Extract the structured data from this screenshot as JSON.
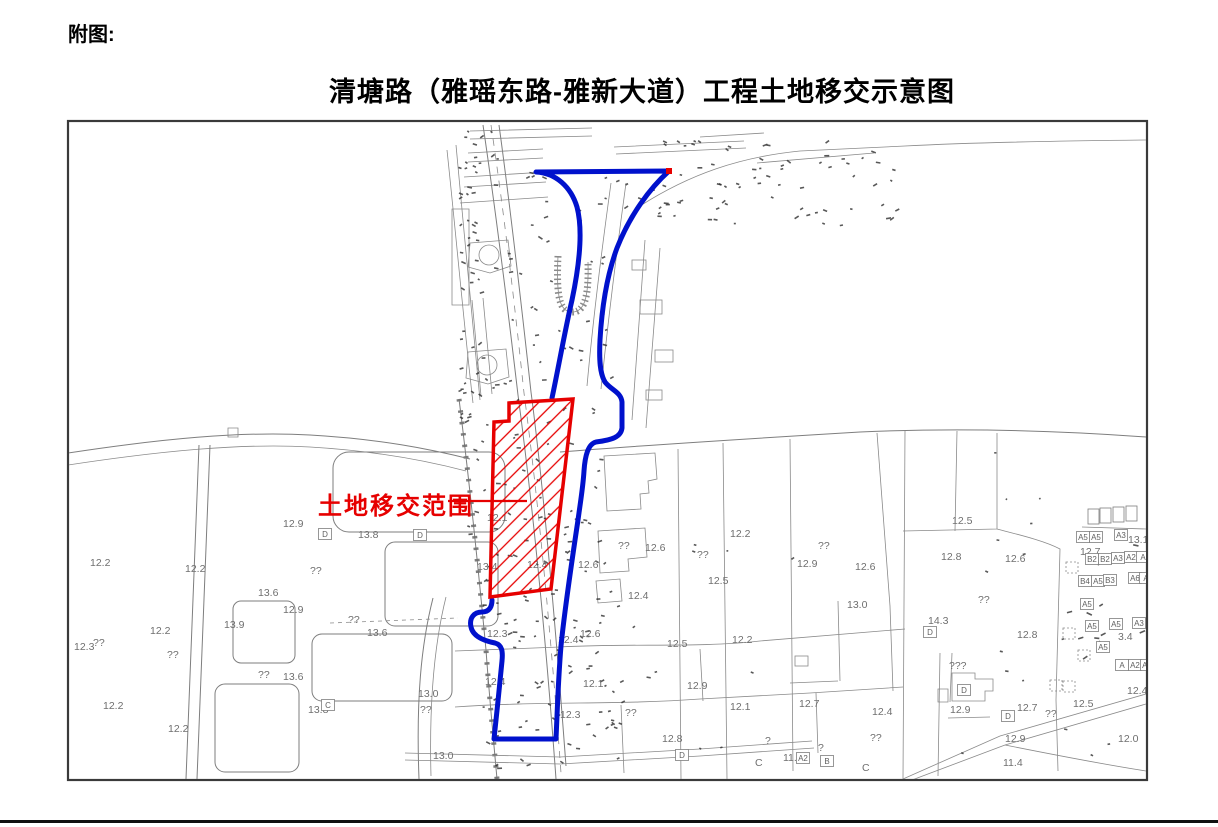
{
  "page": {
    "figure_label": "附图:",
    "title": "清塘路（雅瑶东路-雅新大道）工程土地移交示意图"
  },
  "map": {
    "legend_label": "土地移交范围",
    "colors": {
      "boundary_blue": "#0011cc",
      "transfer_red": "#e60000",
      "base_gray": "#7e7e7e",
      "label_gray": "#6f6f6f"
    },
    "elevation_labels": [
      {
        "t": "12.9",
        "x": 283,
        "y": 527
      },
      {
        "t": "13.8",
        "x": 358,
        "y": 538
      },
      {
        "t": "12.2",
        "x": 90,
        "y": 566
      },
      {
        "t": "12.2",
        "x": 185,
        "y": 572
      },
      {
        "t": "13.6",
        "x": 258,
        "y": 596
      },
      {
        "t": "12.9",
        "x": 283,
        "y": 613
      },
      {
        "t": "??",
        "x": 310,
        "y": 574
      },
      {
        "t": "13.9",
        "x": 224,
        "y": 628
      },
      {
        "t": "??",
        "x": 93,
        "y": 646
      },
      {
        "t": "12.2",
        "x": 150,
        "y": 634
      },
      {
        "t": "12.3",
        "x": 74,
        "y": 650
      },
      {
        "t": "??",
        "x": 167,
        "y": 658
      },
      {
        "t": "12.2",
        "x": 103,
        "y": 709
      },
      {
        "t": "12.2",
        "x": 168,
        "y": 732
      },
      {
        "t": "??",
        "x": 348,
        "y": 623
      },
      {
        "t": "13.6",
        "x": 367,
        "y": 636
      },
      {
        "t": "??",
        "x": 258,
        "y": 678
      },
      {
        "t": "13.6",
        "x": 283,
        "y": 680
      },
      {
        "t": "13.0",
        "x": 418,
        "y": 697
      },
      {
        "t": "13.8",
        "x": 308,
        "y": 713
      },
      {
        "t": "??",
        "x": 420,
        "y": 713
      },
      {
        "t": "13.0",
        "x": 433,
        "y": 759
      },
      {
        "t": "12.1",
        "x": 487,
        "y": 521
      },
      {
        "t": "13.4",
        "x": 477,
        "y": 570
      },
      {
        "t": "12.4",
        "x": 527,
        "y": 568
      },
      {
        "t": "12.3",
        "x": 487,
        "y": 637
      },
      {
        "t": "12.4",
        "x": 485,
        "y": 685
      },
      {
        "t": "12.6",
        "x": 578,
        "y": 568
      },
      {
        "t": "12.4",
        "x": 628,
        "y": 599
      },
      {
        "t": "12.6",
        "x": 580,
        "y": 637
      },
      {
        "t": "12.4",
        "x": 558,
        "y": 643
      },
      {
        "t": "12.1",
        "x": 583,
        "y": 687
      },
      {
        "t": "12.3",
        "x": 560,
        "y": 718
      },
      {
        "t": "??",
        "x": 625,
        "y": 716
      },
      {
        "t": "12.8",
        "x": 662,
        "y": 742
      },
      {
        "t": "12.9",
        "x": 687,
        "y": 689
      },
      {
        "t": "12.5",
        "x": 667,
        "y": 647
      },
      {
        "t": "12.2",
        "x": 732,
        "y": 643
      },
      {
        "t": "12.2",
        "x": 730,
        "y": 537
      },
      {
        "t": "12.5",
        "x": 708,
        "y": 584
      },
      {
        "t": "12.1",
        "x": 730,
        "y": 710
      },
      {
        "t": "??",
        "x": 697,
        "y": 558
      },
      {
        "t": "12.6",
        "x": 645,
        "y": 551
      },
      {
        "t": "??",
        "x": 618,
        "y": 549
      },
      {
        "t": "12.9",
        "x": 797,
        "y": 567
      },
      {
        "t": "??",
        "x": 818,
        "y": 549
      },
      {
        "t": "12.6",
        "x": 855,
        "y": 570
      },
      {
        "t": "13.0",
        "x": 847,
        "y": 608
      },
      {
        "t": "?",
        "x": 765,
        "y": 744
      },
      {
        "t": "11.8",
        "x": 783,
        "y": 761
      },
      {
        "t": "?",
        "x": 818,
        "y": 751
      },
      {
        "t": "C",
        "x": 755,
        "y": 766
      },
      {
        "t": "C",
        "x": 862,
        "y": 771
      },
      {
        "t": "12.7",
        "x": 799,
        "y": 707
      },
      {
        "t": "12.4",
        "x": 872,
        "y": 715
      },
      {
        "t": "??",
        "x": 870,
        "y": 741
      },
      {
        "t": "12.9",
        "x": 950,
        "y": 713
      },
      {
        "t": "12.7",
        "x": 1017,
        "y": 711
      },
      {
        "t": "??",
        "x": 1045,
        "y": 717
      },
      {
        "t": "12.9",
        "x": 1005,
        "y": 742
      },
      {
        "t": "11.4",
        "x": 1003,
        "y": 766
      },
      {
        "t": "???",
        "x": 949,
        "y": 669
      },
      {
        "t": "14.3",
        "x": 928,
        "y": 624
      },
      {
        "t": "12.8",
        "x": 941,
        "y": 560
      },
      {
        "t": "12.5",
        "x": 952,
        "y": 524
      },
      {
        "t": "12.6",
        "x": 1005,
        "y": 562
      },
      {
        "t": "12.7",
        "x": 1080,
        "y": 555
      },
      {
        "t": "13.1",
        "x": 1128,
        "y": 543
      },
      {
        "t": "??",
        "x": 978,
        "y": 603
      },
      {
        "t": "12.8",
        "x": 1017,
        "y": 638
      },
      {
        "t": "12.4",
        "x": 1127,
        "y": 694
      },
      {
        "t": "12.0",
        "x": 1118,
        "y": 742
      },
      {
        "t": "3.4",
        "x": 1118,
        "y": 640
      },
      {
        "t": "12.5",
        "x": 1073,
        "y": 707
      }
    ],
    "boxed_labels": [
      {
        "t": "D",
        "x": 325,
        "y": 537
      },
      {
        "t": "D",
        "x": 420,
        "y": 538
      },
      {
        "t": "C",
        "x": 328,
        "y": 708
      },
      {
        "t": "D",
        "x": 682,
        "y": 758
      },
      {
        "t": "D",
        "x": 930,
        "y": 635
      },
      {
        "t": "D",
        "x": 964,
        "y": 693
      },
      {
        "t": "D",
        "x": 1008,
        "y": 719
      },
      {
        "t": "A2",
        "x": 803,
        "y": 761
      },
      {
        "t": "B",
        "x": 827,
        "y": 764
      },
      {
        "t": "A5",
        "x": 1083,
        "y": 540
      },
      {
        "t": "A5",
        "x": 1096,
        "y": 540
      },
      {
        "t": "A3",
        "x": 1121,
        "y": 538
      },
      {
        "t": "B2",
        "x": 1092,
        "y": 562
      },
      {
        "t": "B2",
        "x": 1105,
        "y": 562
      },
      {
        "t": "A3",
        "x": 1118,
        "y": 561
      },
      {
        "t": "A2",
        "x": 1131,
        "y": 560
      },
      {
        "t": "A",
        "x": 1143,
        "y": 560
      },
      {
        "t": "B4",
        "x": 1085,
        "y": 584
      },
      {
        "t": "A5",
        "x": 1098,
        "y": 584
      },
      {
        "t": "B3",
        "x": 1110,
        "y": 583
      },
      {
        "t": "A6",
        "x": 1135,
        "y": 581
      },
      {
        "t": "A",
        "x": 1146,
        "y": 581
      },
      {
        "t": "A5",
        "x": 1087,
        "y": 607
      },
      {
        "t": "A5",
        "x": 1092,
        "y": 629
      },
      {
        "t": "A5",
        "x": 1116,
        "y": 627
      },
      {
        "t": "A3",
        "x": 1139,
        "y": 626
      },
      {
        "t": "A5",
        "x": 1103,
        "y": 650
      },
      {
        "t": "A",
        "x": 1122,
        "y": 668
      },
      {
        "t": "A2",
        "x": 1135,
        "y": 668
      },
      {
        "t": "A3",
        "x": 1147,
        "y": 668
      }
    ],
    "empty_boxes": [
      {
        "x": 1088,
        "y": 509
      },
      {
        "x": 1100,
        "y": 508
      },
      {
        "x": 1113,
        "y": 507
      },
      {
        "x": 1126,
        "y": 506
      }
    ],
    "dashed_boxes": [
      {
        "x": 1066,
        "y": 562
      },
      {
        "x": 1063,
        "y": 628
      },
      {
        "x": 1078,
        "y": 650
      },
      {
        "x": 1050,
        "y": 680
      },
      {
        "x": 1063,
        "y": 681
      }
    ]
  }
}
